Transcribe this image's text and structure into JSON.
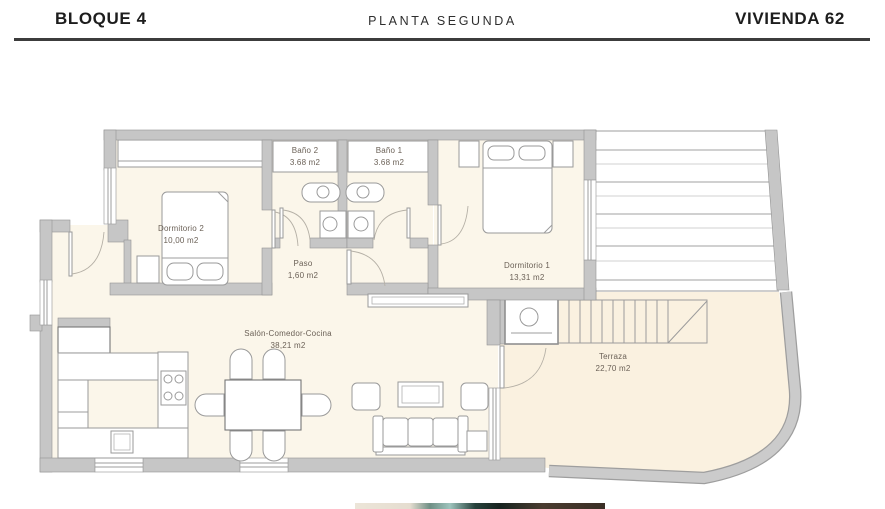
{
  "header": {
    "block": "BLOQUE 4",
    "floor": "PLANTA SEGUNDA",
    "unit": "VIVIENDA 62"
  },
  "rooms": {
    "dormitorio2": {
      "name": "Dormitorio 2",
      "area": "10,00 m2"
    },
    "bano2": {
      "name": "Baño 2",
      "area": "3.68 m2"
    },
    "bano1": {
      "name": "Baño 1",
      "area": "3.68 m2"
    },
    "paso": {
      "name": "Paso",
      "area": "1,60 m2"
    },
    "dormitorio1": {
      "name": "Dormitorio 1",
      "area": "13,31 m2"
    },
    "salon": {
      "name": "Salón-Comedor-Cocina",
      "area": "38,21 m2"
    },
    "terraza": {
      "name": "Terraza",
      "area": "22,70 m2"
    }
  },
  "colors": {
    "floor": "#fbf6ea",
    "terrace_floor": "#faf1e0",
    "wall": "#c6c6c6",
    "label_text": "#6b6157",
    "header_text": "#1d1d1d",
    "divider": "#3c3c3c"
  }
}
